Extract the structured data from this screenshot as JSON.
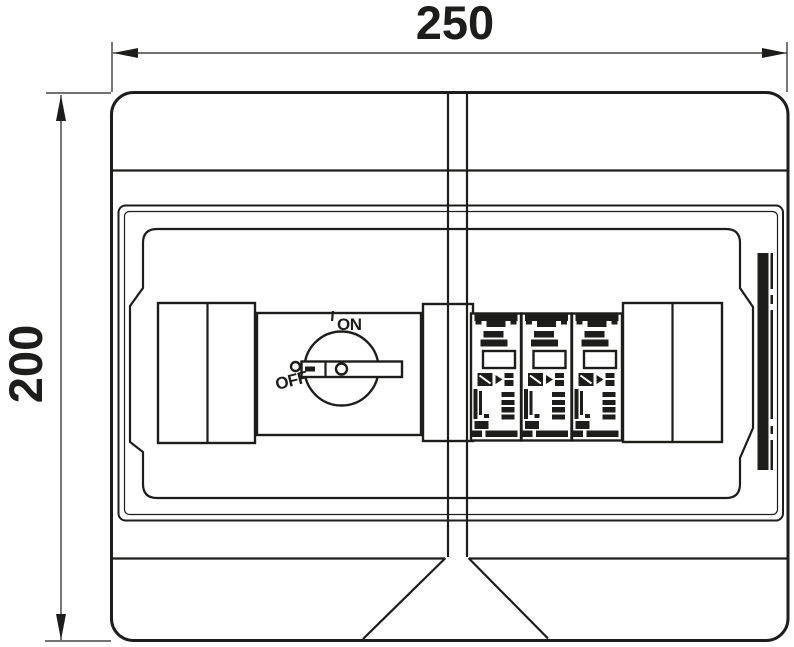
{
  "drawing": {
    "type": "technical-drawing",
    "subject": "enclosure-top-view",
    "dimensions": {
      "width_label": "250",
      "height_label": "200"
    },
    "switch": {
      "on_label": "ON",
      "off_label": "OFF"
    },
    "modules": {
      "count": 3
    },
    "colors": {
      "line": "#1d1d1b",
      "background": "#ffffff"
    }
  }
}
